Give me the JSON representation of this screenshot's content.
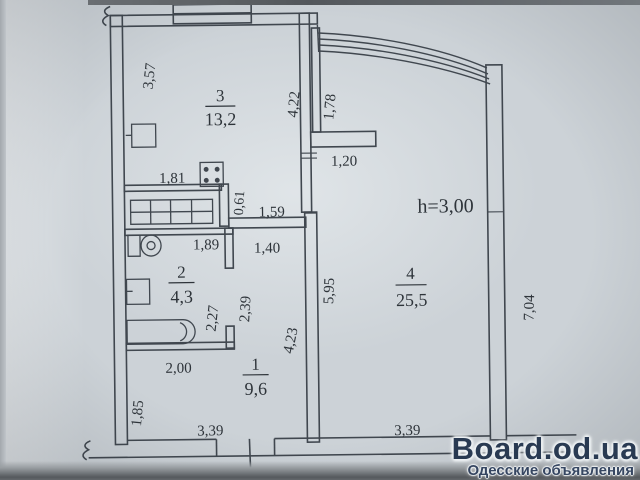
{
  "floor_plan": {
    "ceiling_height": "h=3,00",
    "rooms": [
      {
        "number": "1",
        "area": "9,6"
      },
      {
        "number": "2",
        "area": "4,3"
      },
      {
        "number": "3",
        "area": "13,2"
      },
      {
        "number": "4",
        "area": "25,5"
      }
    ],
    "dimensions": {
      "room3_left": "3,57",
      "room3_right": "4,22",
      "balcony_wall": "1,78",
      "stub_wall": "1,20",
      "kitchen_wall": "1,81",
      "niche_depth": "0,61",
      "niche_width": "1,59",
      "bathroom_width": "1,89",
      "corridor_width": "1,40",
      "corridor_depth": "2,39",
      "bathroom_depth": "2,27",
      "room4_inner_left": "5,95",
      "hall_right_wall": "4,23",
      "room4_right": "7,04",
      "hall_top": "2,00",
      "hall_left": "1,85",
      "hall_bottom": "3,39",
      "room4_bottom": "3,39"
    }
  },
  "watermark": {
    "site": "Board.od.ua",
    "tagline": "Одесские объявления"
  }
}
